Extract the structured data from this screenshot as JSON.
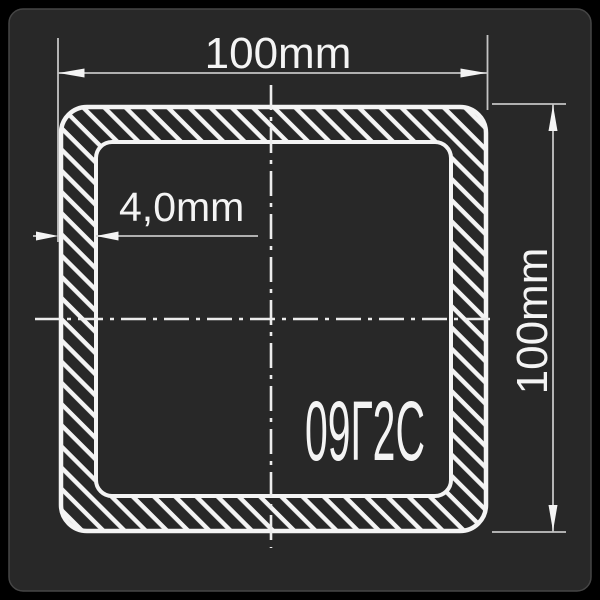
{
  "window": {
    "background": "#000000",
    "panel_color": "#282828",
    "panel_border": "#454545"
  },
  "drawing": {
    "type": "technical-cross-section",
    "subject": "square structural tube profile with hatched wall section",
    "line_color": "#f4f4f4",
    "dim_line_color": "#c4c4c4",
    "labels": {
      "outer_width": "100mm",
      "outer_height": "100mm",
      "wall_thickness": "4,0mm",
      "steel_grade": "09Г2С"
    },
    "values": {
      "outer_width_mm": 100,
      "outer_height_mm": 100,
      "wall_thickness_mm": 4.0,
      "steel_grade": "09Г2С"
    }
  }
}
